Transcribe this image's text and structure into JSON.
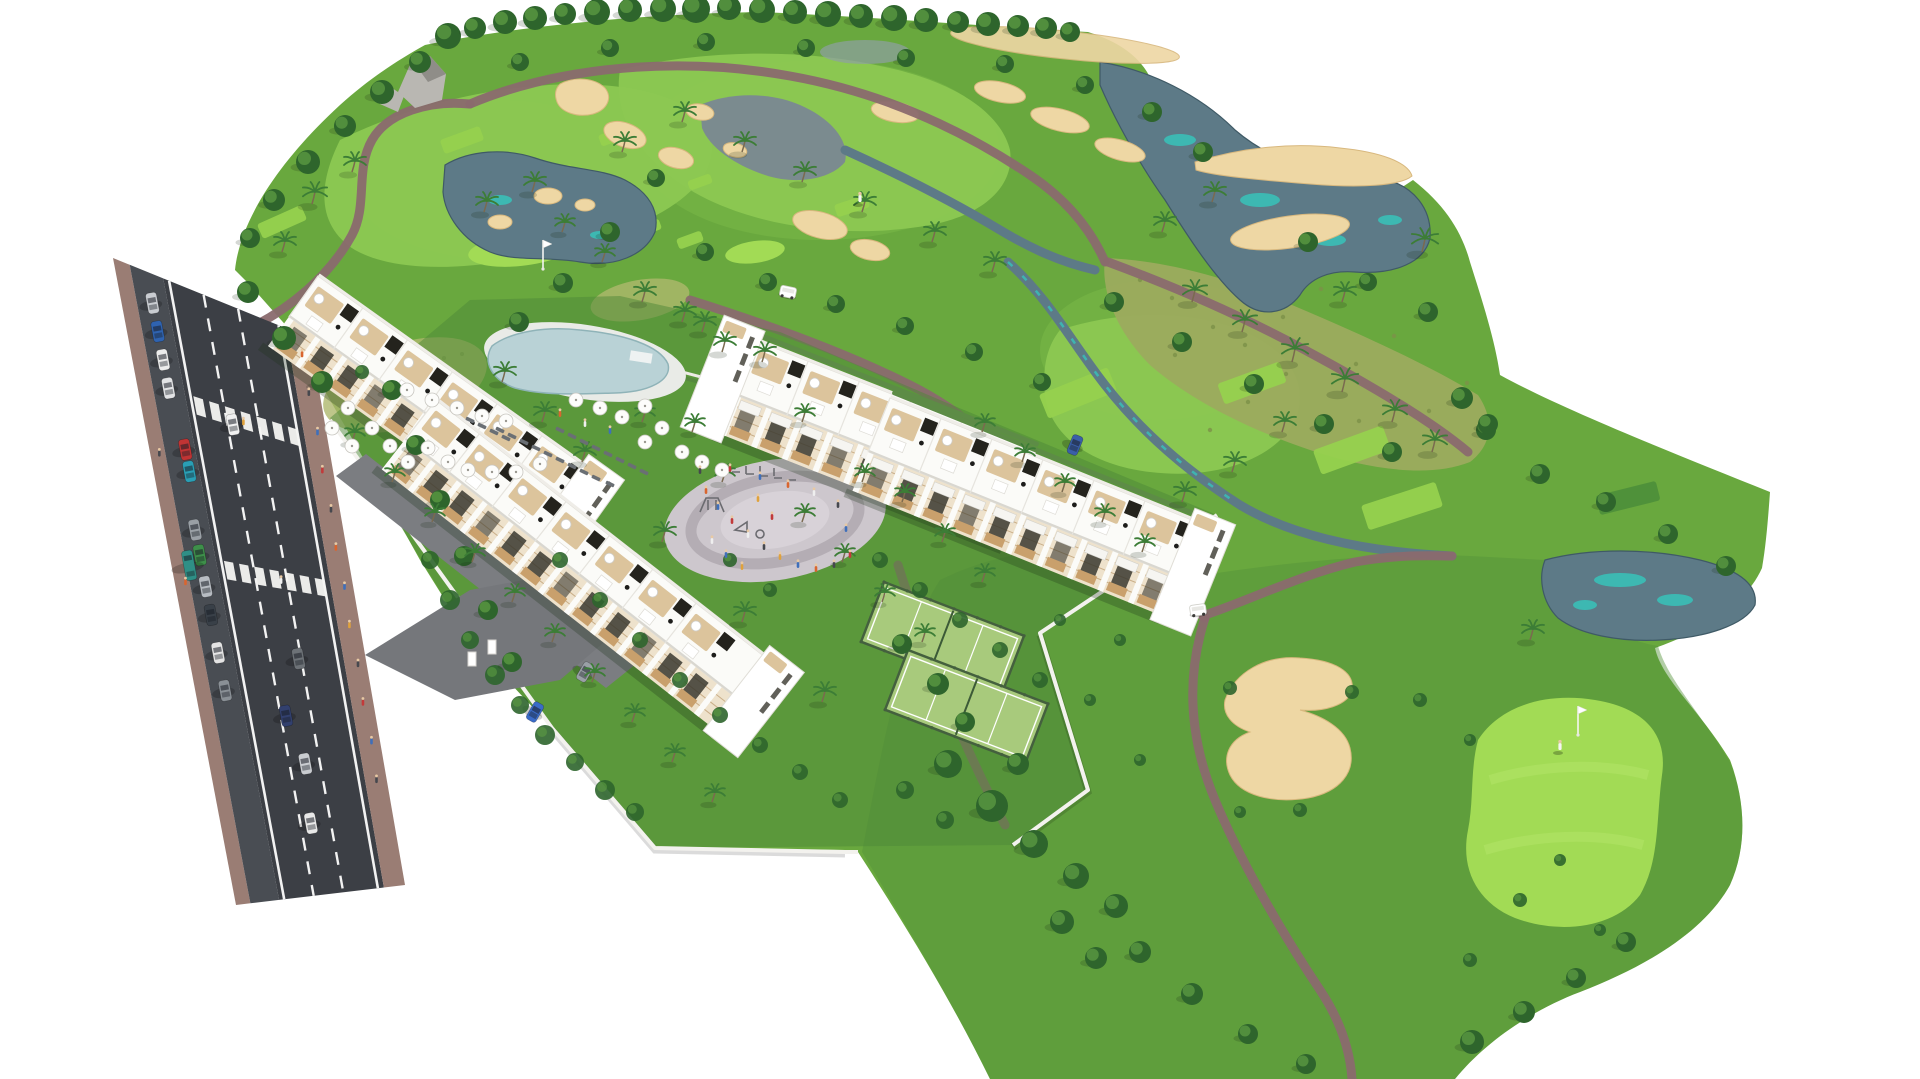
{
  "scene": {
    "type": "aerial-architectural-render",
    "subject": "white-apartment-complex-beside-golf-course",
    "areas": [
      "golf-course",
      "residential-complex",
      "access-road",
      "swimming-pool",
      "playground-plaza",
      "padel-courts",
      "gardens"
    ],
    "golf_features": [
      "fairways",
      "putting-greens",
      "tee-boxes",
      "sand-bunkers",
      "ponds",
      "creek",
      "cart-paths",
      "rock-outcrop",
      "flagsticks",
      "golfers",
      "golf-carts"
    ],
    "residential_features": [
      "apartment-blocks",
      "roof-terraces",
      "pergolas",
      "balconies",
      "perimeter-wall",
      "entrance-driveway",
      "parked-cars",
      "palm-gardens"
    ]
  },
  "palette": {
    "bg": "#ffffff",
    "golf_base": "#69a83e",
    "golf_dark": "#55923a",
    "golf_light": "#7fbf4a",
    "fairway": "#8cc852",
    "green_bright": "#a2db55",
    "green_stripe": "#b2e468",
    "tee_light": "#96d14e",
    "tee_dark": "#4e8f3a",
    "sand": "#eed7a4",
    "sand_edge": "#d8b87e",
    "water": "#5d7a87",
    "water_teal": "#37c3ba",
    "path_mauve": "#8a6a6e",
    "scrub": "#9cab5e",
    "meadow": "#aeb86d",
    "road_asphalt": "#3c3f45",
    "road_parking": "#494d53",
    "sidewalk": "#9a7d74",
    "line_white": "#f2f2f2",
    "building_white": "#fbfbf8",
    "building_edge": "#e0ded7",
    "facade_beige": "#eee2cc",
    "facade_line": "#c9ae88",
    "opening_dark": "#3a382f",
    "wood": "#c9a06c",
    "terrace": "#dcc49c",
    "pergola_dark": "#24231d",
    "wall_white": "#f3f2ee",
    "pool_water": "#b9d2d6",
    "pool_deck": "#e9ebe7",
    "plaza": "#cdc7cd",
    "plaza_ring": "#b4adb4",
    "plaza_inner": "#d8d2d8",
    "padel": "#a8ca7c",
    "padel_fence": "#44603e",
    "tree_dark": "#2e652c",
    "tree_light": "#5d9c43",
    "palm_green": "#3c7d36",
    "trunk": "#7a6a4f",
    "hedge": "#55873f",
    "rock": "#b9b7b2",
    "rock_dark": "#8f8d88",
    "car_colors": [
      "#c9ccd1",
      "#2f63b0",
      "#ececec",
      "#e2e3e5",
      "#c03434",
      "#2a9fb5",
      "#9aa0a6",
      "#3e8f4a",
      "#b7bcc2",
      "#394048",
      "#e4e4e4",
      "#8a9096"
    ]
  },
  "trees_round": [
    [
      448,
      36,
      13
    ],
    [
      475,
      28,
      11
    ],
    [
      505,
      22,
      12
    ],
    [
      535,
      18,
      12
    ],
    [
      565,
      14,
      11
    ],
    [
      597,
      12,
      13
    ],
    [
      630,
      10,
      12
    ],
    [
      663,
      9,
      13
    ],
    [
      696,
      9,
      14
    ],
    [
      729,
      8,
      12
    ],
    [
      762,
      10,
      13
    ],
    [
      795,
      12,
      12
    ],
    [
      828,
      14,
      13
    ],
    [
      861,
      16,
      12
    ],
    [
      894,
      18,
      13
    ],
    [
      926,
      20,
      12
    ],
    [
      958,
      22,
      11
    ],
    [
      988,
      24,
      12
    ],
    [
      1018,
      26,
      11
    ],
    [
      1046,
      28,
      11
    ],
    [
      1070,
      32,
      10
    ],
    [
      420,
      62,
      11
    ],
    [
      382,
      92,
      12
    ],
    [
      345,
      126,
      11
    ],
    [
      308,
      162,
      12
    ],
    [
      274,
      200,
      11
    ],
    [
      250,
      238,
      10
    ],
    [
      248,
      292,
      11
    ],
    [
      284,
      338,
      12
    ],
    [
      322,
      382,
      11
    ],
    [
      520,
      62,
      9
    ],
    [
      610,
      48,
      9
    ],
    [
      706,
      42,
      9
    ],
    [
      806,
      48,
      9
    ],
    [
      906,
      58,
      9
    ],
    [
      1005,
      64,
      9
    ],
    [
      1085,
      85,
      9
    ],
    [
      1152,
      112,
      10
    ],
    [
      1203,
      152,
      10
    ],
    [
      656,
      178,
      9
    ],
    [
      610,
      232,
      10
    ],
    [
      563,
      283,
      10
    ],
    [
      519,
      322,
      10
    ],
    [
      705,
      252,
      9
    ],
    [
      768,
      282,
      9
    ],
    [
      836,
      304,
      9
    ],
    [
      905,
      326,
      9
    ],
    [
      974,
      352,
      9
    ],
    [
      1042,
      382,
      9
    ],
    [
      1114,
      302,
      10
    ],
    [
      1182,
      342,
      10
    ],
    [
      1254,
      384,
      10
    ],
    [
      1324,
      424,
      10
    ],
    [
      1392,
      452,
      10
    ],
    [
      1308,
      242,
      10
    ],
    [
      1368,
      282,
      9
    ],
    [
      1428,
      312,
      10
    ],
    [
      1462,
      398,
      11
    ],
    [
      1486,
      430,
      10
    ],
    [
      1488,
      424,
      10
    ],
    [
      1540,
      474,
      10
    ],
    [
      1606,
      502,
      10
    ],
    [
      1668,
      534,
      10
    ],
    [
      1726,
      566,
      10
    ],
    [
      948,
      764,
      14
    ],
    [
      992,
      806,
      16
    ],
    [
      1034,
      844,
      14
    ],
    [
      1076,
      876,
      13
    ],
    [
      1116,
      906,
      12
    ],
    [
      965,
      722,
      10
    ],
    [
      1018,
      764,
      11
    ],
    [
      1140,
      952,
      11
    ],
    [
      1192,
      994,
      11
    ],
    [
      1248,
      1034,
      10
    ],
    [
      1306,
      1064,
      10
    ],
    [
      1472,
      1042,
      12
    ],
    [
      1524,
      1012,
      11
    ],
    [
      1576,
      978,
      10
    ],
    [
      1626,
      942,
      10
    ],
    [
      902,
      644,
      10
    ],
    [
      938,
      684,
      11
    ],
    [
      1062,
      922,
      12
    ],
    [
      1096,
      958,
      11
    ],
    [
      392,
      390,
      10
    ],
    [
      416,
      445,
      10
    ],
    [
      440,
      500,
      10
    ],
    [
      464,
      556,
      10
    ],
    [
      488,
      610,
      10
    ],
    [
      512,
      662,
      10
    ]
  ],
  "palms": [
    [
      312,
      204,
      1.1
    ],
    [
      352,
      172,
      1
    ],
    [
      282,
      252,
      1
    ],
    [
      484,
      212,
      1
    ],
    [
      532,
      192,
      1
    ],
    [
      622,
      152,
      1
    ],
    [
      682,
      122,
      1
    ],
    [
      742,
      152,
      1
    ],
    [
      802,
      182,
      1
    ],
    [
      862,
      212,
      1
    ],
    [
      932,
      242,
      1
    ],
    [
      992,
      272,
      1
    ],
    [
      642,
      302,
      1
    ],
    [
      702,
      332,
      1
    ],
    [
      762,
      362,
      1
    ],
    [
      562,
      232,
      0.9
    ],
    [
      602,
      262,
      0.9
    ],
    [
      1192,
      302,
      1.1
    ],
    [
      1242,
      332,
      1.1
    ],
    [
      1292,
      362,
      1.2
    ],
    [
      1342,
      392,
      1.2
    ],
    [
      1392,
      422,
      1.1
    ],
    [
      1432,
      452,
      1.1
    ],
    [
      1342,
      302,
      1
    ],
    [
      1422,
      252,
      1.2
    ],
    [
      1282,
      432,
      1
    ],
    [
      1232,
      472,
      1
    ],
    [
      1182,
      502,
      1
    ],
    [
      1162,
      232,
      1
    ],
    [
      1212,
      202,
      1
    ],
    [
      502,
      382,
      1
    ],
    [
      542,
      422,
      1
    ],
    [
      582,
      462,
      1
    ],
    [
      662,
      542,
      1
    ],
    [
      742,
      622,
      1
    ],
    [
      822,
      702,
      1
    ],
    [
      642,
      422,
      0.9
    ],
    [
      722,
      482,
      0.9
    ],
    [
      802,
      522,
      0.9
    ],
    [
      842,
      562,
      0.9
    ],
    [
      882,
      602,
      0.9
    ],
    [
      922,
      642,
      0.9
    ],
    [
      862,
      482,
      0.9
    ],
    [
      902,
      502,
      0.9
    ],
    [
      942,
      542,
      0.9
    ],
    [
      982,
      582,
      0.9
    ],
    [
      352,
      442,
      0.9
    ],
    [
      392,
      482,
      0.9
    ],
    [
      432,
      522,
      0.9
    ],
    [
      472,
      562,
      0.9
    ],
    [
      512,
      602,
      0.9
    ],
    [
      552,
      642,
      0.9
    ],
    [
      592,
      682,
      0.9
    ],
    [
      632,
      722,
      0.9
    ],
    [
      672,
      762,
      0.9
    ],
    [
      712,
      802,
      0.9
    ],
    [
      682,
      322,
      1
    ],
    [
      722,
      352,
      1
    ],
    [
      802,
      422,
      0.9
    ],
    [
      692,
      432,
      0.9
    ],
    [
      982,
      432,
      0.9
    ],
    [
      1022,
      462,
      0.9
    ],
    [
      1062,
      492,
      0.9
    ],
    [
      1102,
      522,
      0.9
    ],
    [
      1142,
      552,
      0.9
    ],
    [
      1530,
      640,
      1
    ]
  ],
  "bushes": [
    [
      430,
      560,
      9
    ],
    [
      450,
      600,
      10
    ],
    [
      470,
      640,
      9
    ],
    [
      495,
      675,
      10
    ],
    [
      520,
      705,
      9
    ],
    [
      545,
      735,
      10
    ],
    [
      575,
      762,
      9
    ],
    [
      605,
      790,
      10
    ],
    [
      635,
      812,
      9
    ],
    [
      560,
      560,
      8
    ],
    [
      600,
      600,
      8
    ],
    [
      640,
      640,
      8
    ],
    [
      680,
      680,
      8
    ],
    [
      720,
      715,
      8
    ],
    [
      760,
      745,
      8
    ],
    [
      800,
      772,
      8
    ],
    [
      840,
      800,
      8
    ],
    [
      880,
      560,
      8
    ],
    [
      920,
      590,
      8
    ],
    [
      960,
      620,
      8
    ],
    [
      1000,
      650,
      8
    ],
    [
      1040,
      680,
      8
    ],
    [
      905,
      790,
      9
    ],
    [
      945,
      820,
      9
    ],
    [
      730,
      560,
      7
    ],
    [
      770,
      590,
      7
    ],
    [
      1230,
      688,
      7
    ],
    [
      1352,
      692,
      7
    ],
    [
      1300,
      810,
      7
    ],
    [
      1240,
      812,
      6
    ],
    [
      1420,
      700,
      7
    ],
    [
      1470,
      740,
      6
    ],
    [
      1520,
      900,
      7
    ],
    [
      1560,
      860,
      6
    ],
    [
      1600,
      930,
      6
    ],
    [
      1470,
      960,
      7
    ],
    [
      1090,
      700,
      6
    ],
    [
      1140,
      760,
      6
    ],
    [
      1060,
      620,
      6
    ],
    [
      1120,
      640,
      6
    ],
    [
      362,
      372,
      7
    ]
  ],
  "umbrellas": [
    [
      348,
      408
    ],
    [
      332,
      428
    ],
    [
      352,
      446
    ],
    [
      372,
      428
    ],
    [
      390,
      446
    ],
    [
      408,
      462
    ],
    [
      428,
      448
    ],
    [
      448,
      462
    ],
    [
      468,
      470
    ],
    [
      492,
      472
    ],
    [
      516,
      472
    ],
    [
      540,
      464
    ],
    [
      407,
      390
    ],
    [
      432,
      400
    ],
    [
      457,
      408
    ],
    [
      482,
      416
    ],
    [
      506,
      421
    ],
    [
      576,
      400
    ],
    [
      600,
      408
    ],
    [
      622,
      417
    ],
    [
      645,
      406
    ],
    [
      662,
      428
    ],
    [
      682,
      452
    ],
    [
      702,
      462
    ],
    [
      722,
      470
    ],
    [
      645,
      442
    ]
  ],
  "loungers": [
    [
      500,
      430
    ],
    [
      512,
      436
    ],
    [
      524,
      442
    ],
    [
      536,
      448
    ],
    [
      548,
      454
    ],
    [
      560,
      460
    ],
    [
      572,
      466
    ],
    [
      584,
      472
    ],
    [
      596,
      478
    ],
    [
      610,
      484
    ],
    [
      560,
      430
    ],
    [
      572,
      436
    ],
    [
      584,
      442
    ],
    [
      596,
      448
    ],
    [
      608,
      454
    ],
    [
      620,
      460
    ],
    [
      632,
      466
    ],
    [
      644,
      472
    ],
    [
      470,
      420
    ],
    [
      482,
      426
    ],
    [
      494,
      432
    ],
    [
      506,
      438
    ]
  ],
  "tees": [
    [
      282,
      222,
      48,
      16,
      -24,
      0
    ],
    [
      462,
      140,
      42,
      15,
      -20,
      0
    ],
    [
      556,
      176,
      36,
      13,
      -20,
      0
    ],
    [
      614,
      136,
      30,
      12,
      -20,
      0
    ],
    [
      648,
      228,
      26,
      11,
      -20,
      0
    ],
    [
      700,
      182,
      24,
      10,
      -20,
      0
    ],
    [
      852,
      206,
      34,
      13,
      -18,
      0
    ],
    [
      690,
      240,
      26,
      11,
      -20,
      0
    ],
    [
      1078,
      393,
      74,
      26,
      -22,
      0
    ],
    [
      1252,
      383,
      66,
      22,
      -20,
      0
    ],
    [
      1352,
      450,
      74,
      26,
      -20,
      0
    ],
    [
      1402,
      506,
      78,
      26,
      -18,
      0
    ],
    [
      1628,
      498,
      62,
      20,
      -14,
      1
    ]
  ],
  "plaza_people": [
    [
      706,
      492,
      "#d9652f"
    ],
    [
      718,
      508,
      "#3f6fba"
    ],
    [
      732,
      522,
      "#c23a3a"
    ],
    [
      748,
      536,
      "#efefef"
    ],
    [
      764,
      548,
      "#46484e"
    ],
    [
      780,
      558,
      "#e0a23c"
    ],
    [
      798,
      566,
      "#3f6fba"
    ],
    [
      816,
      570,
      "#d9652f"
    ],
    [
      834,
      566,
      "#46484e"
    ],
    [
      850,
      556,
      "#c23a3a"
    ],
    [
      712,
      542,
      "#efefef"
    ],
    [
      726,
      556,
      "#3f6fba"
    ],
    [
      742,
      568,
      "#e0a23c"
    ],
    [
      700,
      472,
      "#46484e"
    ],
    [
      730,
      470,
      "#c23a3a"
    ],
    [
      760,
      478,
      "#3f6fba"
    ],
    [
      788,
      486,
      "#d9652f"
    ],
    [
      814,
      494,
      "#efefef"
    ],
    [
      838,
      506,
      "#46484e"
    ],
    [
      846,
      530,
      "#3f6fba"
    ],
    [
      772,
      518,
      "#c23a3a"
    ],
    [
      758,
      500,
      "#e0a23c"
    ],
    [
      560,
      415,
      "#d9652f"
    ],
    [
      585,
      425,
      "#efefef"
    ],
    [
      610,
      432,
      "#3f6fba"
    ]
  ],
  "road": {
    "crosswalk_t": [
      0.2,
      0.467
    ],
    "sidewalk_people": [
      [
        0.04,
        0.94,
        "#d9652f"
      ],
      [
        0.11,
        0.94,
        "#46484e"
      ],
      [
        0.18,
        0.95,
        "#3f6fba"
      ],
      [
        0.25,
        0.94,
        "#c23a3a"
      ],
      [
        0.32,
        0.95,
        "#46484e"
      ],
      [
        0.39,
        0.94,
        "#d9652f"
      ],
      [
        0.46,
        0.95,
        "#3f6fba"
      ],
      [
        0.53,
        0.94,
        "#e0a23c"
      ],
      [
        0.6,
        0.95,
        "#46484e"
      ],
      [
        0.67,
        0.94,
        "#c23a3a"
      ],
      [
        0.74,
        0.95,
        "#3f6fba"
      ],
      [
        0.3,
        0.05,
        "#46484e"
      ],
      [
        0.5,
        0.06,
        "#d9652f"
      ],
      [
        0.81,
        0.94,
        "#46484e"
      ],
      [
        0.205,
        0.55,
        "#e0a23c"
      ],
      [
        0.47,
        0.6,
        "#efefef"
      ]
    ],
    "parked_cars": [
      [
        0.05,
        0.17,
        "#c9ccd1"
      ],
      [
        0.095,
        0.17,
        "#2f63b0"
      ],
      [
        0.14,
        0.17,
        "#ececec"
      ],
      [
        0.185,
        0.17,
        "#e2e3e5"
      ],
      [
        0.28,
        0.2,
        "#c03434"
      ],
      [
        0.315,
        0.2,
        "#2a9fb5"
      ],
      [
        0.41,
        0.17,
        "#9aa0a6"
      ],
      [
        0.45,
        0.17,
        "#3e8f4a"
      ],
      [
        0.5,
        0.17,
        "#b7bcc2"
      ],
      [
        0.545,
        0.17,
        "#394048"
      ],
      [
        0.605,
        0.17,
        "#e4e4e4"
      ],
      [
        0.665,
        0.17,
        "#8a9096"
      ]
    ],
    "truck": [
      0.47,
      0.1,
      "#2f8f86"
    ],
    "moving_cars": [
      [
        0.213,
        0.49,
        "#f0f0f0"
      ],
      [
        0.7,
        0.49,
        "#32406e"
      ],
      [
        0.78,
        0.55,
        "#c9ccd0"
      ],
      [
        0.6,
        0.62,
        "#6d7277"
      ],
      [
        0.88,
        0.52,
        "#e8e8e8"
      ]
    ]
  },
  "complex_cars": [
    [
      535,
      712,
      30,
      "#3a6bc7"
    ],
    [
      585,
      672,
      30,
      "#9aa0a6"
    ],
    [
      1075,
      445,
      22,
      "#3a5fa8"
    ]
  ],
  "buildings": [
    {
      "x": 318,
      "y": 276,
      "angle": 35.5,
      "len": 330,
      "roofW": 50,
      "facW": 36,
      "row": "A",
      "towerStart": false,
      "towerEnd": true
    },
    {
      "x": 436,
      "y": 400,
      "angle": 38,
      "len": 420,
      "roofW": 50,
      "facW": 38,
      "row": "A",
      "towerStart": false,
      "towerEnd": true
    },
    {
      "x": 757,
      "y": 341,
      "angle": 21.5,
      "len": 300,
      "roofW": 58,
      "facW": 42,
      "row": "B",
      "towerStart": true,
      "towerEnd": false
    },
    {
      "x": 890,
      "y": 398,
      "angle": 22,
      "len": 330,
      "roofW": 58,
      "facW": 42,
      "row": "B",
      "towerStart": false,
      "towerEnd": true
    }
  ],
  "padel_courts": [
    {
      "x": 884,
      "y": 582,
      "angle": 21,
      "w": 150,
      "h": 64
    },
    {
      "x": 908,
      "y": 650,
      "angle": 21,
      "w": 150,
      "h": 64
    }
  ],
  "golf_props": {
    "flags": [
      [
        543,
        240
      ],
      [
        1578,
        706
      ]
    ],
    "golfers": [
      [
        1560,
        748
      ],
      [
        860,
        200
      ]
    ],
    "carts": [
      [
        1198,
        610,
        -8
      ],
      [
        788,
        292,
        12
      ]
    ]
  }
}
